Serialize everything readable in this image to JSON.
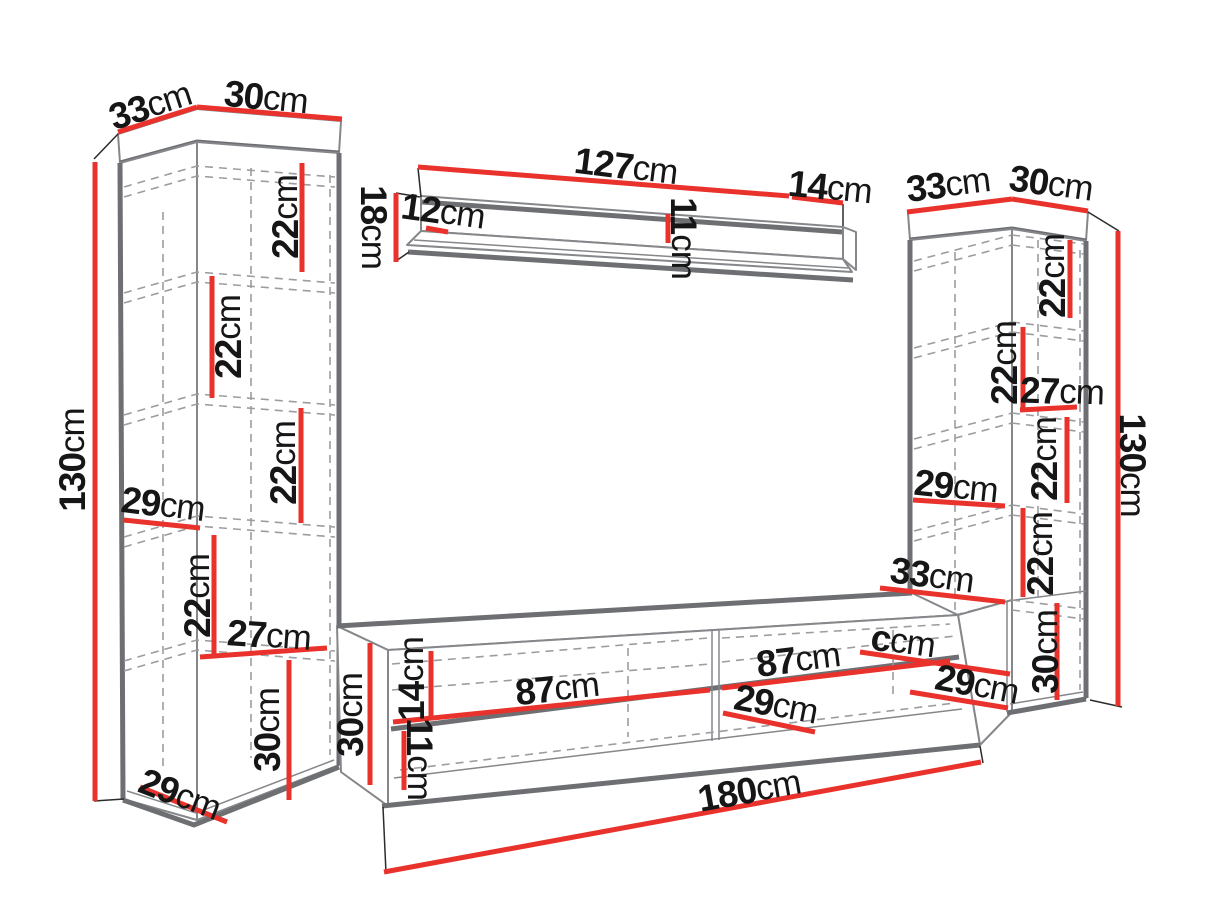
{
  "colors": {
    "red": "#e9322b",
    "edge": "#6d6f72",
    "thin": "#85878a",
    "dash": "#9b9da0",
    "ink": "#161616",
    "bg": "#ffffff"
  },
  "labels": [
    {
      "id": "left-top-depth",
      "num": "33",
      "unit": "cm",
      "x": 150,
      "y": 105,
      "rot": -18
    },
    {
      "id": "left-top-width",
      "num": "30",
      "unit": "cm",
      "x": 266,
      "y": 97,
      "rot": 6
    },
    {
      "id": "left-height",
      "num": "130",
      "unit": "cm",
      "x": 72,
      "y": 460,
      "rot": -90
    },
    {
      "id": "left-section-1",
      "num": "22",
      "unit": "cm",
      "x": 285,
      "y": 217,
      "rot": -90
    },
    {
      "id": "left-section-2",
      "num": "22",
      "unit": "cm",
      "x": 228,
      "y": 337,
      "rot": -90
    },
    {
      "id": "left-section-3",
      "num": "22",
      "unit": "cm",
      "x": 283,
      "y": 463,
      "rot": -90
    },
    {
      "id": "left-inner-width",
      "num": "29",
      "unit": "cm",
      "x": 163,
      "y": 504,
      "rot": 7
    },
    {
      "id": "left-section-4",
      "num": "22",
      "unit": "cm",
      "x": 197,
      "y": 596,
      "rot": -90
    },
    {
      "id": "left-inner-depth",
      "num": "27",
      "unit": "cm",
      "x": 269,
      "y": 635,
      "rot": 4
    },
    {
      "id": "left-bottom-height",
      "num": "30",
      "unit": "cm",
      "x": 267,
      "y": 730,
      "rot": -90
    },
    {
      "id": "left-bottom-depth",
      "num": "29",
      "unit": "cm",
      "x": 180,
      "y": 794,
      "rot": 21
    },
    {
      "id": "shelf-width",
      "num": "127",
      "unit": "cm",
      "x": 626,
      "y": 166,
      "rot": 7
    },
    {
      "id": "shelf-depth",
      "num": "14",
      "unit": "cm",
      "x": 830,
      "y": 187,
      "rot": 6
    },
    {
      "id": "shelf-height",
      "num": "18",
      "unit": "cm",
      "x": 374,
      "y": 227,
      "rot": 90
    },
    {
      "id": "shelf-board-depth",
      "num": "12",
      "unit": "cm",
      "x": 443,
      "y": 211,
      "rot": 8
    },
    {
      "id": "shelf-back-height",
      "num": "11",
      "unit": "cm",
      "x": 684,
      "y": 238,
      "rot": 90
    },
    {
      "id": "right-top-depth",
      "num": "33",
      "unit": "cm",
      "x": 948,
      "y": 184,
      "rot": -7
    },
    {
      "id": "right-top-width",
      "num": "30",
      "unit": "cm",
      "x": 1051,
      "y": 183,
      "rot": 8
    },
    {
      "id": "right-height",
      "num": "130",
      "unit": "cm",
      "x": 1133,
      "y": 465,
      "rot": 90
    },
    {
      "id": "right-section-1",
      "num": "22",
      "unit": "cm",
      "x": 1052,
      "y": 276,
      "rot": -90
    },
    {
      "id": "right-section-2",
      "num": "22",
      "unit": "cm",
      "x": 1004,
      "y": 363,
      "rot": -90
    },
    {
      "id": "right-inner-depth",
      "num": "27",
      "unit": "cm",
      "x": 1062,
      "y": 391,
      "rot": 2
    },
    {
      "id": "right-section-3",
      "num": "22",
      "unit": "cm",
      "x": 1044,
      "y": 459,
      "rot": -90
    },
    {
      "id": "right-inner-width",
      "num": "29",
      "unit": "cm",
      "x": 956,
      "y": 486,
      "rot": 6
    },
    {
      "id": "right-section-4",
      "num": "22",
      "unit": "cm",
      "x": 1040,
      "y": 554,
      "rot": -90
    },
    {
      "id": "right-bottom-height",
      "num": "30",
      "unit": "cm",
      "x": 1045,
      "y": 652,
      "rot": -90
    },
    {
      "id": "right-bottom-depth",
      "num": "29",
      "unit": "cm",
      "x": 977,
      "y": 684,
      "rot": 11
    },
    {
      "id": "tv-top-depth",
      "num": "33",
      "unit": "cm",
      "x": 932,
      "y": 575,
      "rot": 8
    },
    {
      "id": "tv-unlabeled",
      "num": "c",
      "unit": "cm",
      "x": 903,
      "y": 641,
      "rot": 8
    },
    {
      "id": "tv-section-left",
      "num": "87",
      "unit": "cm",
      "x": 557,
      "y": 688,
      "rot": -6
    },
    {
      "id": "tv-section-right",
      "num": "87",
      "unit": "cm",
      "x": 798,
      "y": 659,
      "rot": -7
    },
    {
      "id": "tv-mid-depth",
      "num": "29",
      "unit": "cm",
      "x": 776,
      "y": 704,
      "rot": 11
    },
    {
      "id": "tv-height",
      "num": "30",
      "unit": "cm",
      "x": 350,
      "y": 715,
      "rot": -90
    },
    {
      "id": "tv-upper-height",
      "num": "14",
      "unit": "cm",
      "x": 411,
      "y": 679,
      "rot": -90
    },
    {
      "id": "tv-lower-height",
      "num": "11",
      "unit": "cm",
      "x": 420,
      "y": 759,
      "rot": 90
    },
    {
      "id": "tv-width",
      "num": "180",
      "unit": "cm",
      "x": 749,
      "y": 790,
      "rot": -10
    }
  ],
  "red_lines": [
    {
      "id": "left-top-depth-line",
      "x1": 118,
      "y1": 132,
      "x2": 197,
      "y2": 107
    },
    {
      "id": "left-top-width-line",
      "x1": 197,
      "y1": 107,
      "x2": 342,
      "y2": 119
    },
    {
      "id": "left-height-line",
      "x1": 95,
      "y1": 162,
      "x2": 95,
      "y2": 801
    },
    {
      "id": "left-section-1-line",
      "x1": 302,
      "y1": 163,
      "x2": 302,
      "y2": 272
    },
    {
      "id": "left-section-2-line",
      "x1": 212,
      "y1": 276,
      "x2": 212,
      "y2": 398
    },
    {
      "id": "left-section-3-line",
      "x1": 301,
      "y1": 408,
      "x2": 301,
      "y2": 523
    },
    {
      "id": "left-inner-width-line",
      "x1": 123,
      "y1": 520,
      "x2": 200,
      "y2": 528
    },
    {
      "id": "left-section-4-line",
      "x1": 214,
      "y1": 535,
      "x2": 214,
      "y2": 657
    },
    {
      "id": "left-inner-depth-line",
      "x1": 200,
      "y1": 657,
      "x2": 327,
      "y2": 648
    },
    {
      "id": "left-bottom-height-line",
      "x1": 289,
      "y1": 660,
      "x2": 289,
      "y2": 800
    },
    {
      "id": "left-bottom-depth-line",
      "x1": 140,
      "y1": 787,
      "x2": 227,
      "y2": 822
    },
    {
      "id": "shelf-width-line",
      "x1": 418,
      "y1": 167,
      "x2": 789,
      "y2": 196
    },
    {
      "id": "shelf-depth-line",
      "x1": 792,
      "y1": 197,
      "x2": 843,
      "y2": 203
    },
    {
      "id": "shelf-height-line",
      "x1": 396,
      "y1": 193,
      "x2": 396,
      "y2": 262
    },
    {
      "id": "shelf-board-depth-line",
      "x1": 426,
      "y1": 228,
      "x2": 448,
      "y2": 232
    },
    {
      "id": "shelf-back-height-line",
      "x1": 668,
      "y1": 214,
      "x2": 668,
      "y2": 243
    },
    {
      "id": "right-top-depth-line",
      "x1": 907,
      "y1": 212,
      "x2": 1012,
      "y2": 199
    },
    {
      "id": "right-top-width-line",
      "x1": 1012,
      "y1": 199,
      "x2": 1088,
      "y2": 211
    },
    {
      "id": "right-height-line",
      "x1": 1118,
      "y1": 231,
      "x2": 1118,
      "y2": 706
    },
    {
      "id": "right-section-1-line",
      "x1": 1070,
      "y1": 240,
      "x2": 1070,
      "y2": 318
    },
    {
      "id": "right-section-2-line",
      "x1": 1023,
      "y1": 327,
      "x2": 1023,
      "y2": 410
    },
    {
      "id": "right-inner-depth-line",
      "x1": 1020,
      "y1": 410,
      "x2": 1077,
      "y2": 407
    },
    {
      "id": "right-section-3-line",
      "x1": 1067,
      "y1": 417,
      "x2": 1067,
      "y2": 503
    },
    {
      "id": "right-inner-width-line",
      "x1": 913,
      "y1": 500,
      "x2": 1005,
      "y2": 506
    },
    {
      "id": "right-section-4-line",
      "x1": 1023,
      "y1": 508,
      "x2": 1023,
      "y2": 597
    },
    {
      "id": "right-bottom-height-line",
      "x1": 1057,
      "y1": 603,
      "x2": 1057,
      "y2": 700
    },
    {
      "id": "right-bottom-depth-line",
      "x1": 910,
      "y1": 692,
      "x2": 1008,
      "y2": 708
    },
    {
      "id": "tv-top-depth-line",
      "x1": 880,
      "y1": 588,
      "x2": 1005,
      "y2": 602
    },
    {
      "id": "tv-unlabeled-line",
      "x1": 860,
      "y1": 652,
      "x2": 1010,
      "y2": 674
    },
    {
      "id": "tv-section-left-line",
      "x1": 393,
      "y1": 722,
      "x2": 710,
      "y2": 690
    },
    {
      "id": "tv-section-right-line",
      "x1": 722,
      "y1": 688,
      "x2": 950,
      "y2": 661
    },
    {
      "id": "tv-mid-depth-line",
      "x1": 723,
      "y1": 713,
      "x2": 815,
      "y2": 732
    },
    {
      "id": "tv-height-line",
      "x1": 370,
      "y1": 643,
      "x2": 370,
      "y2": 785
    },
    {
      "id": "tv-upper-height-line",
      "x1": 431,
      "y1": 651,
      "x2": 431,
      "y2": 719
    },
    {
      "id": "tv-lower-height-line",
      "x1": 404,
      "y1": 731,
      "x2": 404,
      "y2": 790
    },
    {
      "id": "tv-width-line",
      "x1": 384,
      "y1": 872,
      "x2": 981,
      "y2": 762
    }
  ]
}
